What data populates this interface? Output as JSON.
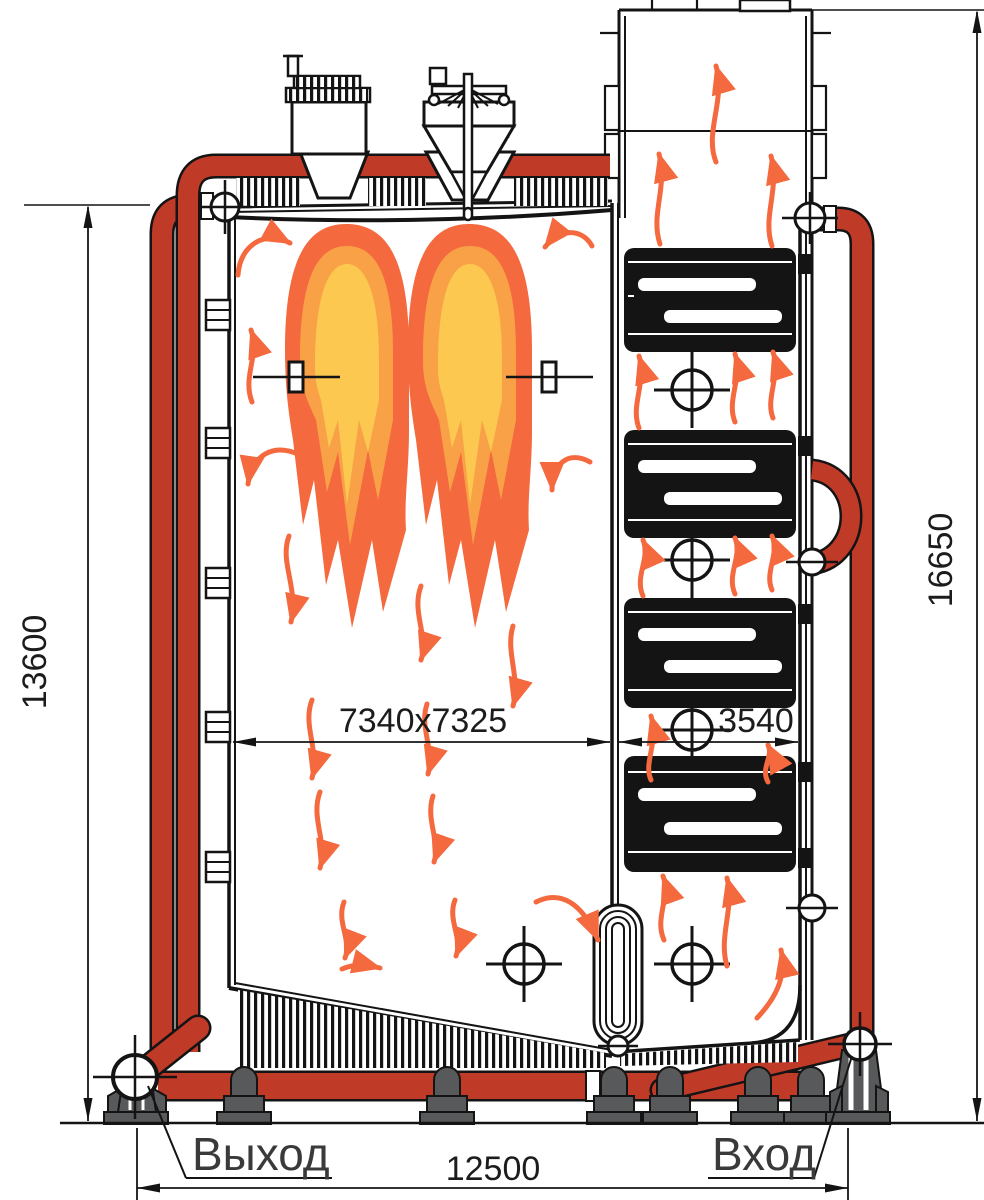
{
  "drawing": {
    "type": "boiler-cross-section-technical-drawing",
    "labels": {
      "outlet": "Выход",
      "inlet": "Вход"
    },
    "dimensions": {
      "left_height": "13600",
      "right_height": "16650",
      "furnace_width": "7340x7325",
      "convective_width": "3540",
      "overall_length": "12500"
    },
    "colors": {
      "pipe_red": "#C03A28",
      "arrow_orange": "#F5693E",
      "flame_outer": "#F5693E",
      "flame_mid": "#F9A147",
      "flame_inner": "#FCC84F",
      "support_gray": "#58595B",
      "line_black": "#141414"
    }
  }
}
